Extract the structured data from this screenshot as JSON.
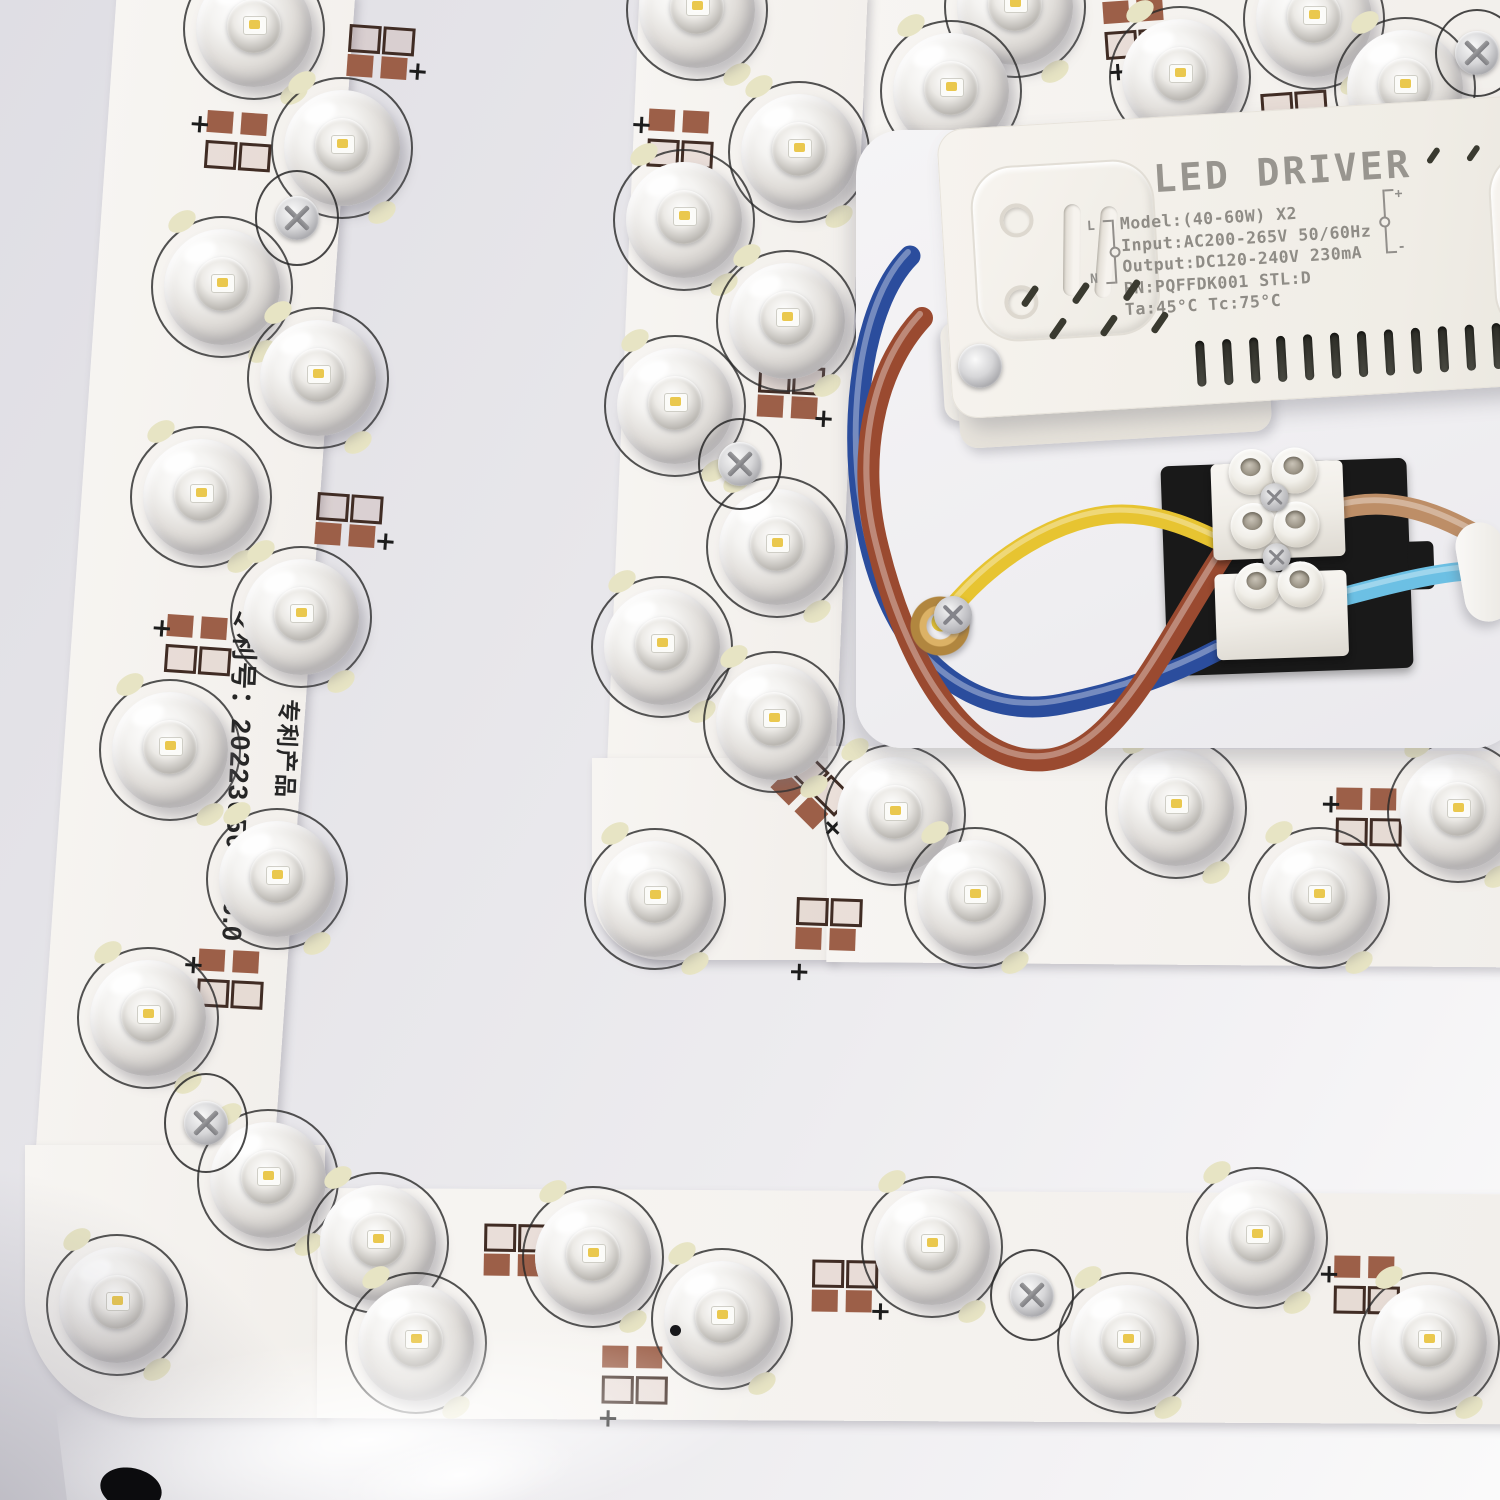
{
  "scene": {
    "symbols": {
      "plus": "+"
    },
    "colors": {
      "pcb": "#f7f5f2",
      "pan_dark": "#e3e2e7",
      "pan_light": "#fafafa",
      "copper_pad": "#9c5f48",
      "pad_outline": "#402c24",
      "printed_arc": "#282828",
      "lens_tab": "#e7e4c4",
      "phosphor_dot": "#eac84e",
      "driver_body": "#f2efe9",
      "driver_text": "#8f8c86",
      "terminal_plate_black": "#191919",
      "terminal_white": "#f3f1ec",
      "gold_ring": "#c79b4e",
      "wire_blue": "#2b4d9d",
      "wire_brown": "#9a4a30",
      "wire_yellow": "#e7c431",
      "wire_tan": "#bd8e67",
      "wire_cyan": "#6cc0e4"
    },
    "driver": {
      "title": "LED DRIVER",
      "lines": [
        "Model:(40-60W) X2",
        "Input:AC200-265V 50/60Hz",
        "Output:DC120-240V 230mA",
        "PN:PQFFDK001 STL:D",
        "Ta:45°C Tc:75°C"
      ],
      "terminals": {
        "lt": "L",
        "lb": "N",
        "rt": "+",
        "rb": "-"
      },
      "vents": {
        "bottom_slots": 14,
        "mid_per_row": 3,
        "top_slashes": 3
      }
    },
    "pcb_text": {
      "patent_no": "专利号：202230506086.0",
      "patent_product": "专利产品"
    },
    "strips": [
      {
        "x": 118,
        "y": -25,
        "w": 238,
        "h": 1300,
        "rot": 4,
        "rad": "0px"
      },
      {
        "x": 846,
        "y": -130,
        "w": 690,
        "h": 360,
        "rot": -4.3,
        "rad": "0px"
      },
      {
        "x": 640,
        "y": -20,
        "w": 228,
        "h": 790,
        "rot": 2.4,
        "rad": "0px"
      },
      {
        "x": 25,
        "y": 1145,
        "w": 300,
        "h": 273,
        "rot": 0,
        "rad": "0 0 0 120px"
      },
      {
        "x": 318,
        "y": 1188,
        "w": 1192,
        "h": 230,
        "rot": 0.3,
        "rad": "0px"
      },
      {
        "x": 592,
        "y": 758,
        "w": 240,
        "h": 202,
        "rot": 0,
        "rad": "0 0 0 70px"
      },
      {
        "x": 828,
        "y": 746,
        "w": 692,
        "h": 216,
        "rot": 0.45,
        "rad": "0px"
      }
    ],
    "leds": [
      [
        254,
        29
      ],
      [
        342,
        148
      ],
      [
        222,
        287
      ],
      [
        318,
        378
      ],
      [
        201,
        497
      ],
      [
        301,
        617
      ],
      [
        170,
        750
      ],
      [
        277,
        879
      ],
      [
        148,
        1018
      ],
      [
        268,
        1180
      ],
      [
        117,
        1305
      ],
      [
        378,
        1243
      ],
      [
        416,
        1343
      ],
      [
        593,
        1257
      ],
      [
        722,
        1319
      ],
      [
        932,
        1247
      ],
      [
        1128,
        1343
      ],
      [
        1257,
        1238
      ],
      [
        1429,
        1343
      ],
      [
        697,
        10
      ],
      [
        799,
        152
      ],
      [
        684,
        220
      ],
      [
        787,
        321
      ],
      [
        675,
        406
      ],
      [
        777,
        547
      ],
      [
        662,
        647
      ],
      [
        774,
        722
      ],
      [
        655,
        899
      ],
      [
        895,
        815
      ],
      [
        975,
        898
      ],
      [
        1176,
        808
      ],
      [
        1319,
        898
      ],
      [
        1458,
        812
      ],
      [
        1015,
        7
      ],
      [
        951,
        91
      ],
      [
        1180,
        77
      ],
      [
        1314,
        19
      ],
      [
        1405,
        88
      ]
    ],
    "screws": [
      {
        "x": 297,
        "y": 218,
        "h": 96
      },
      {
        "x": 206,
        "y": 1123,
        "h": 100
      },
      {
        "x": 1032,
        "y": 1295,
        "h": 92
      },
      {
        "x": 740,
        "y": 464,
        "h": 92
      },
      {
        "x": 1477,
        "y": 53,
        "h": 88
      }
    ],
    "pads": [
      {
        "x": 348,
        "y": 26,
        "rot": 4,
        "order": "of",
        "px": 60,
        "py": 30
      },
      {
        "x": 206,
        "y": 112,
        "rot": 4,
        "order": "fo",
        "px": -18,
        "py": 2
      },
      {
        "x": 316,
        "y": 494,
        "rot": 4,
        "order": "of",
        "px": 60,
        "py": 32
      },
      {
        "x": 166,
        "y": 616,
        "rot": 4,
        "order": "fo",
        "px": -16,
        "py": 2
      },
      {
        "x": 198,
        "y": 950,
        "rot": 3,
        "order": "fo",
        "px": -16,
        "py": 4
      },
      {
        "x": 484,
        "y": 1224,
        "rot": 1,
        "order": "of",
        "px": 60,
        "py": 8
      },
      {
        "x": 602,
        "y": 1346,
        "rot": 1,
        "order": "fo",
        "px": -4,
        "py": 60
      },
      {
        "x": 1334,
        "y": 1256,
        "rot": 1,
        "order": "fo",
        "px": -16,
        "py": 6
      },
      {
        "x": 812,
        "y": 1260,
        "rot": 1,
        "order": "of",
        "px": 58,
        "py": 38
      },
      {
        "x": 648,
        "y": 110,
        "rot": 3,
        "order": "fo",
        "px": -18,
        "py": 4
      },
      {
        "x": 758,
        "y": 366,
        "rot": 3,
        "order": "of",
        "px": 56,
        "py": 38
      },
      {
        "x": 780,
        "y": 764,
        "rot": 45,
        "order": "of",
        "px": 62,
        "py": 24
      },
      {
        "x": 796,
        "y": 898,
        "rot": 2,
        "order": "of",
        "px": -6,
        "py": 62
      },
      {
        "x": 1104,
        "y": 0,
        "rot": -4,
        "order": "fo",
        "px": 0,
        "py": 58
      },
      {
        "x": 1262,
        "y": 92,
        "rot": -4,
        "order": "of",
        "px": 56,
        "py": 34
      },
      {
        "x": 1336,
        "y": 788,
        "rot": 1,
        "order": "fo",
        "px": -16,
        "py": 4
      }
    ],
    "dots": [
      [
        675,
        1330
      ]
    ],
    "wires": [
      {
        "name": "wire-blue",
        "color": "#2b4d9d",
        "w": 21,
        "d": "M910,256 C848,318 840,500 892,608 C928,682 992,718 1062,704 C1124,692 1176,672 1218,650"
      },
      {
        "name": "wire-brown",
        "color": "#9a4a30",
        "w": 22,
        "d": "M922,318 C872,372 856,462 878,548 C902,646 958,768 1046,760 C1118,753 1162,646 1228,546"
      },
      {
        "name": "wire-tan",
        "color": "#bd8e67",
        "w": 21,
        "d": "M1336,510 C1396,492 1452,518 1504,552"
      },
      {
        "name": "wire-cyan",
        "color": "#6cc0e4",
        "w": 19,
        "d": "M1338,598 C1406,580 1452,568 1504,570"
      },
      {
        "name": "wire-yellow",
        "color": "#e7c431",
        "w": 19,
        "d": "M941,622 C988,558 1062,514 1122,514 C1164,514 1196,530 1234,548"
      }
    ]
  }
}
